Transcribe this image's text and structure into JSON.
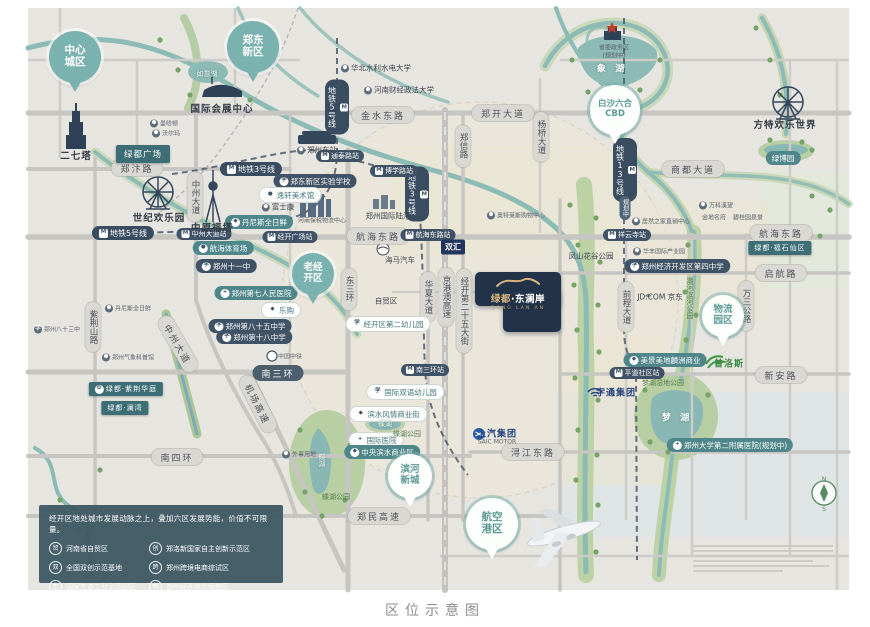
{
  "caption": "区位示意图",
  "project": {
    "brand": "绿都",
    "name": "东澜岸",
    "full_name": "绿都·东澜岸",
    "latin": "DONG LAN AN"
  },
  "legend": {
    "title": "经开区地处城市发展动脉之上，叠加六区发展势能，价值不可限量。",
    "items": [
      {
        "label": "河南省自贸区",
        "icon": "贸"
      },
      {
        "label": "郑洛新国家自主创新示范区",
        "icon": "创"
      },
      {
        "label": "全国双创示范基地",
        "icon": "双"
      },
      {
        "label": "郑州跨境电商综试区",
        "icon": "跨"
      },
      {
        "label": "国家生态工业示范园区",
        "icon": "生"
      },
      {
        "label": "郑州经开综合保税区",
        "icon": "税"
      }
    ]
  },
  "colors": {
    "badge_teal": "#79b2ae",
    "pill_teal": "#4e868a",
    "navy": "#3f5266",
    "plate_navy": "#223349",
    "gold": "#d9b27c",
    "water": "#8cbab4",
    "park": "#b7cfa0",
    "legend_bg": "#405a64"
  },
  "badges": [
    {
      "n": "central-city",
      "lines": [
        "中心",
        "城区"
      ],
      "x": 75,
      "y": 57,
      "kind": "teal",
      "size": 52,
      "fs": 10.5
    },
    {
      "n": "zhengdong-new-district",
      "lines": [
        "郑东",
        "新区"
      ],
      "x": 253,
      "y": 47,
      "kind": "teal",
      "size": 52,
      "fs": 10.5
    },
    {
      "n": "baisha-cbd",
      "lines": [
        "白沙六合",
        "CBD"
      ],
      "x": 615,
      "y": 110,
      "kind": "white",
      "size": 50,
      "fs": 8.5
    },
    {
      "n": "old-jingkai-district",
      "lines": [
        "老经",
        "开区"
      ],
      "x": 313,
      "y": 274,
      "kind": "teal",
      "size": 42,
      "fs": 9.5
    },
    {
      "n": "logistics-park",
      "lines": [
        "物流",
        "园区"
      ],
      "x": 723,
      "y": 316,
      "kind": "white",
      "size": 42,
      "fs": 9.5
    },
    {
      "n": "binhe-new-town",
      "lines": [
        "滨河",
        "新城"
      ],
      "x": 410,
      "y": 476,
      "kind": "white",
      "size": 44,
      "fs": 9.5
    },
    {
      "n": "airport-port-area",
      "lines": [
        "航空",
        "港区"
      ],
      "x": 492,
      "y": 524,
      "kind": "white",
      "size": 52,
      "fs": 10.5
    }
  ],
  "labels": [
    {
      "t": "金水东路",
      "x": 383,
      "y": 115,
      "c": "road-h"
    },
    {
      "t": "郑开大道",
      "x": 503,
      "y": 113,
      "c": "road-h"
    },
    {
      "t": "郑汴路",
      "x": 137,
      "y": 168,
      "c": "road-h"
    },
    {
      "t": "商都大道",
      "x": 693,
      "y": 169,
      "c": "road-h"
    },
    {
      "t": "航海东路",
      "x": 378,
      "y": 236,
      "c": "road-h"
    },
    {
      "t": "航海东路",
      "x": 781,
      "y": 233,
      "c": "road-h"
    },
    {
      "t": "启航路",
      "x": 781,
      "y": 273,
      "c": "road-h"
    },
    {
      "t": "南三环",
      "x": 278,
      "y": 373,
      "c": "road-h road-dark"
    },
    {
      "t": "新安路",
      "x": 781,
      "y": 375,
      "c": "road-h"
    },
    {
      "t": "浔江东路",
      "x": 533,
      "y": 452,
      "c": "road-h"
    },
    {
      "t": "南四环",
      "x": 177,
      "y": 457,
      "c": "road-h"
    },
    {
      "t": "郑民高速",
      "x": 379,
      "y": 516,
      "c": "road-h"
    },
    {
      "t": "机场高速",
      "x": 258,
      "y": 404,
      "c": "road-h",
      "r": 63
    },
    {
      "t": "中州大道",
      "x": 178,
      "y": 344,
      "c": "road-h",
      "r": 60
    },
    {
      "t": "中州大道",
      "x": 195,
      "y": 197,
      "c": "road-v"
    },
    {
      "t": "郑信路",
      "x": 463,
      "y": 146,
      "c": "road-v"
    },
    {
      "t": "杨桥大道",
      "x": 541,
      "y": 137,
      "c": "road-v"
    },
    {
      "t": "东三环",
      "x": 349,
      "y": 289,
      "c": "road-v"
    },
    {
      "t": "华夏大道",
      "x": 428,
      "y": 297,
      "c": "road-v"
    },
    {
      "t": "京港澳高速",
      "x": 446,
      "y": 297,
      "c": "road-v"
    },
    {
      "t": "经开第二十五大街",
      "x": 464,
      "y": 311,
      "c": "road-v"
    },
    {
      "t": "前程大道",
      "x": 626,
      "y": 307,
      "c": "road-v"
    },
    {
      "t": "万三公路",
      "x": 746,
      "y": 306,
      "c": "road-v"
    },
    {
      "t": "紫荆山路",
      "x": 93,
      "y": 327,
      "c": "road-v"
    },
    {
      "t": "地铁5号线",
      "x": 337,
      "y": 107,
      "c": "metro-v",
      "i": "m"
    },
    {
      "t": "地铁5号线",
      "x": 123,
      "y": 233,
      "c": "metro",
      "i": "m"
    },
    {
      "t": "地铁3号线",
      "x": 251,
      "y": 169,
      "c": "metro",
      "i": "m"
    },
    {
      "t": "地铁3号线",
      "x": 417,
      "y": 194,
      "c": "metro-v",
      "i": "m"
    },
    {
      "t": "地铁13号线",
      "x": 625,
      "y": 170,
      "c": "metro-v",
      "i": "m"
    },
    {
      "t": "规划中",
      "x": 625,
      "y": 208,
      "c": "metro-v metro-sub"
    },
    {
      "t": "通泰路站",
      "x": 340,
      "y": 156,
      "c": "station",
      "i": "m"
    },
    {
      "t": "博学路站",
      "x": 394,
      "y": 171,
      "c": "station",
      "i": "m"
    },
    {
      "t": "中州大道站",
      "x": 204,
      "y": 234,
      "c": "station",
      "i": "m"
    },
    {
      "t": "经开广场站",
      "x": 290,
      "y": 237,
      "c": "station",
      "i": "m"
    },
    {
      "t": "航海东路站",
      "x": 428,
      "y": 235,
      "c": "station",
      "i": "m"
    },
    {
      "t": "南三环站",
      "x": 425,
      "y": 370,
      "c": "station",
      "i": "m"
    },
    {
      "t": "祥云寺站",
      "x": 627,
      "y": 235,
      "c": "station",
      "i": "m"
    },
    {
      "t": "平道社区站",
      "x": 637,
      "y": 373,
      "c": "station",
      "i": "m"
    },
    {
      "t": "郑东新区实验学校",
      "x": 315,
      "y": 181,
      "c": "navy",
      "i": "school"
    },
    {
      "t": "郑州十一中",
      "x": 226,
      "y": 266,
      "c": "navy",
      "i": "school"
    },
    {
      "t": "郑州第八十五中学",
      "x": 250,
      "y": 326,
      "c": "navy",
      "i": "school"
    },
    {
      "t": "郑州第十八中学",
      "x": 254,
      "y": 337,
      "c": "navy",
      "i": "school"
    },
    {
      "t": "郑州经济开发区第四中学",
      "x": 677,
      "y": 266,
      "c": "navy",
      "i": "school"
    },
    {
      "t": "郑州第七人民医院",
      "x": 256,
      "y": 293,
      "c": "pill-teal",
      "i": "hosp"
    },
    {
      "t": "郑州大学第二附属医院(规划中)",
      "x": 730,
      "y": 445,
      "c": "pill-teal",
      "i": "hosp"
    },
    {
      "t": "国际医院",
      "x": 376,
      "y": 440,
      "c": "pill-white",
      "i": "hosp"
    },
    {
      "t": "国际双语幼儿园",
      "x": 405,
      "y": 392,
      "c": "pill-white",
      "i": "school"
    },
    {
      "t": "经开区第二幼儿园",
      "x": 388,
      "y": 324,
      "c": "pill-white",
      "i": "school"
    },
    {
      "t": "丹尼斯全日鲜",
      "x": 259,
      "y": 222,
      "c": "pill-teal",
      "i": "shop"
    },
    {
      "t": "航海体育场",
      "x": 223,
      "y": 248,
      "c": "pill-teal",
      "i": "dot"
    },
    {
      "t": "绿博园",
      "x": 783,
      "y": 158,
      "c": "pill-teal"
    },
    {
      "t": "美景美地麟洲商业",
      "x": 665,
      "y": 360,
      "c": "pill-teal",
      "i": "shop"
    },
    {
      "t": "中央滨水商业区",
      "x": 382,
      "y": 452,
      "c": "pill-teal",
      "i": "shop"
    },
    {
      "t": "滨水风情商业街",
      "x": 388,
      "y": 414,
      "c": "pill-white",
      "i": "shop"
    },
    {
      "t": "乐购",
      "x": 281,
      "y": 310,
      "c": "pill-white",
      "i": "shop"
    },
    {
      "t": "逸轩美术馆",
      "x": 290,
      "y": 195,
      "c": "pill-white",
      "i": "dot"
    },
    {
      "t": "绿都广场",
      "x": 143,
      "y": 154,
      "c": "box-teal"
    },
    {
      "t": "绿都·福石仙区",
      "x": 780,
      "y": 248,
      "c": "box-teal box-sm"
    },
    {
      "t": "绿都·紫荆华庭",
      "x": 126,
      "y": 389,
      "c": "box-teal box-sm",
      "i": "flower"
    },
    {
      "t": "绿都·澜湾",
      "x": 125,
      "y": 408,
      "c": "box-teal box-sm"
    },
    {
      "t": "二七塔",
      "x": 76,
      "y": 155,
      "c": "txt"
    },
    {
      "t": "国际会展中心",
      "x": 222,
      "y": 108,
      "c": "txt"
    },
    {
      "t": "如意湖",
      "x": 207,
      "y": 74,
      "c": "lake-xs"
    },
    {
      "t": "象 湖",
      "x": 612,
      "y": 68,
      "c": "lake"
    },
    {
      "t": "华北水利水电大学",
      "x": 376,
      "y": 68,
      "c": "txt-xs plain",
      "i": "dot"
    },
    {
      "t": "河南财经政法大学",
      "x": 399,
      "y": 90,
      "c": "txt-xs plain",
      "i": "dot"
    },
    {
      "t": "郑州东站",
      "x": 317,
      "y": 150,
      "c": "txt-xs plain",
      "i": "dot"
    },
    {
      "t": "曼哈顿",
      "x": 164,
      "y": 123,
      "c": "txt-2xs plain",
      "i": "dot"
    },
    {
      "t": "沃尔玛",
      "x": 166,
      "y": 133,
      "c": "txt-2xs plain",
      "i": "dot"
    },
    {
      "t": "富士康",
      "x": 278,
      "y": 207,
      "c": "txt-xs plain",
      "i": "dot"
    },
    {
      "t": "河南保税物流中心",
      "x": 322,
      "y": 220,
      "c": "txt-2xs"
    },
    {
      "t": "世纪欢乐园",
      "x": 159,
      "y": 217,
      "c": "txt"
    },
    {
      "t": "中原福塔",
      "x": 212,
      "y": 227,
      "c": "txt"
    },
    {
      "t": "丹尼斯全日鲜",
      "x": 128,
      "y": 308,
      "c": "txt-2xs plain",
      "i": "dot"
    },
    {
      "t": "郑州八十三中",
      "x": 57,
      "y": 329,
      "c": "txt-2xs plain",
      "i": "school"
    },
    {
      "t": "郑州气象科普馆",
      "x": 128,
      "y": 357,
      "c": "txt-2xs plain",
      "i": "dot"
    },
    {
      "t": "郑州国际陆港",
      "x": 388,
      "y": 216,
      "c": "txt-xs"
    },
    {
      "t": "海马汽车",
      "x": 400,
      "y": 260,
      "c": "txt-xs"
    },
    {
      "t": "自贸区",
      "x": 386,
      "y": 301,
      "c": "txt-xs"
    },
    {
      "t": "奥特莱斯购物中心",
      "x": 516,
      "y": 215,
      "c": "txt-2xs plain",
      "i": "dot"
    },
    {
      "t": "双汇",
      "x": 453,
      "y": 247,
      "c": "box-navy"
    },
    {
      "t": "凤山花谷公园",
      "x": 591,
      "y": 256,
      "c": "txt-xs"
    },
    {
      "t": "居然之家直销中心",
      "x": 661,
      "y": 221,
      "c": "txt-2xs plain",
      "i": "dot"
    },
    {
      "t": "华丰国际产业园",
      "x": 659,
      "y": 251,
      "c": "txt-2xs plain",
      "i": "dot"
    },
    {
      "t": "万科溪望",
      "x": 716,
      "y": 205,
      "c": "txt-2xs plain",
      "i": "dot"
    },
    {
      "t": "金地名府",
      "x": 714,
      "y": 217,
      "c": "txt-2xs"
    },
    {
      "t": "碧桂园泉景",
      "x": 748,
      "y": 217,
      "c": "txt-2xs"
    },
    {
      "t": "JD.COM 京东",
      "x": 660,
      "y": 297,
      "c": "txt-xs"
    },
    {
      "t": "宇通集团",
      "x": 616,
      "y": 392,
      "c": "brand-blue"
    },
    {
      "t": "普洛斯",
      "x": 729,
      "y": 363,
      "c": "brand-green"
    },
    {
      "t": "上汽集团",
      "x": 497,
      "y": 433,
      "c": "brand-blue"
    },
    {
      "t": "SAIC MOTOR",
      "x": 497,
      "y": 442,
      "c": "txt-2xs"
    },
    {
      "t": "外事用地",
      "x": 299,
      "y": 454,
      "c": "txt-2xs plain",
      "i": "dot"
    },
    {
      "t": "梦湖湿地公园",
      "x": 663,
      "y": 383,
      "c": "txt-green"
    },
    {
      "t": "中国中铁",
      "x": 290,
      "y": 356,
      "c": "txt-2xs"
    },
    {
      "t": "省委政务区",
      "x": 614,
      "y": 47,
      "c": "txt-2xs"
    },
    {
      "t": "(规划中)",
      "x": 614,
      "y": 55,
      "c": "txt-2xs"
    },
    {
      "t": "方特欢乐世界",
      "x": 785,
      "y": 124,
      "c": "txt"
    },
    {
      "t": "蝶湖",
      "x": 385,
      "y": 424,
      "c": "lake-xs"
    },
    {
      "t": "蝶湖公园",
      "x": 407,
      "y": 434,
      "c": "txt-green"
    },
    {
      "t": "蝶湖",
      "x": 322,
      "y": 460,
      "c": "lake-xs vert"
    },
    {
      "t": "蝶湖公园",
      "x": 336,
      "y": 497,
      "c": "txt-green"
    },
    {
      "t": "梦 湖",
      "x": 677,
      "y": 417,
      "c": "lake"
    },
    {
      "t": "潮河滨河公园",
      "x": 690,
      "y": 298,
      "c": "txt-green vert"
    }
  ]
}
